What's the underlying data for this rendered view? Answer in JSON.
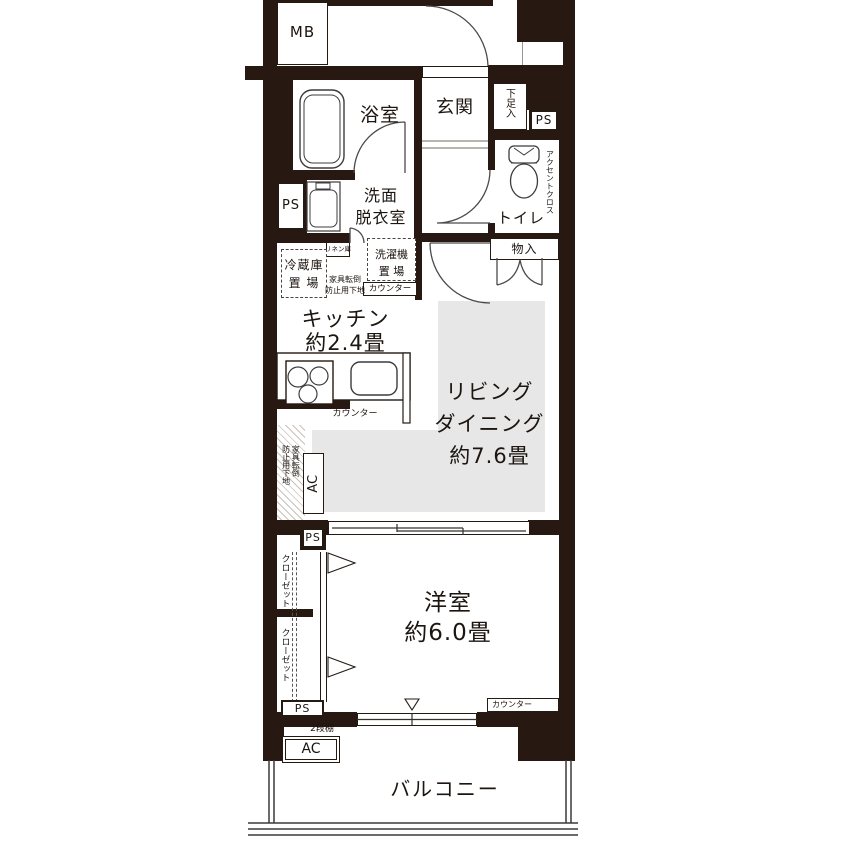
{
  "colors": {
    "wall": "#271811",
    "living_floor": "#e7e7e7",
    "line": "#4a4a4a",
    "background": "#ffffff"
  },
  "labels": {
    "mb": "MB",
    "bath": "浴室",
    "entrance": "玄関",
    "shoe_cabinet": "下足入",
    "ps": "PS",
    "toilet": "トイレ",
    "accent_cross": "アクセントクロス",
    "storage": "物入",
    "washroom_line1": "洗面",
    "washroom_line2": "脱衣室",
    "linen": "リネン庫",
    "fridge_line1": "冷蔵庫",
    "fridge_line2": "置 場",
    "anti_tip_line1": "家具転倒",
    "anti_tip_line2": "防止用下地",
    "washer_line1": "洗濯機",
    "washer_line2": "置 場",
    "counter": "カウンター",
    "kitchen_line1": "キッチン",
    "kitchen_line2": "約2.4畳",
    "living_line1": "リビング",
    "living_line2": "ダイニング",
    "living_line3": "約7.6畳",
    "ac": "AC",
    "closet": "クローゼット",
    "bedroom_line1": "洋室",
    "bedroom_line2": "約6.0畳",
    "shelf": "2段棚",
    "balcony": "バルコニー"
  }
}
